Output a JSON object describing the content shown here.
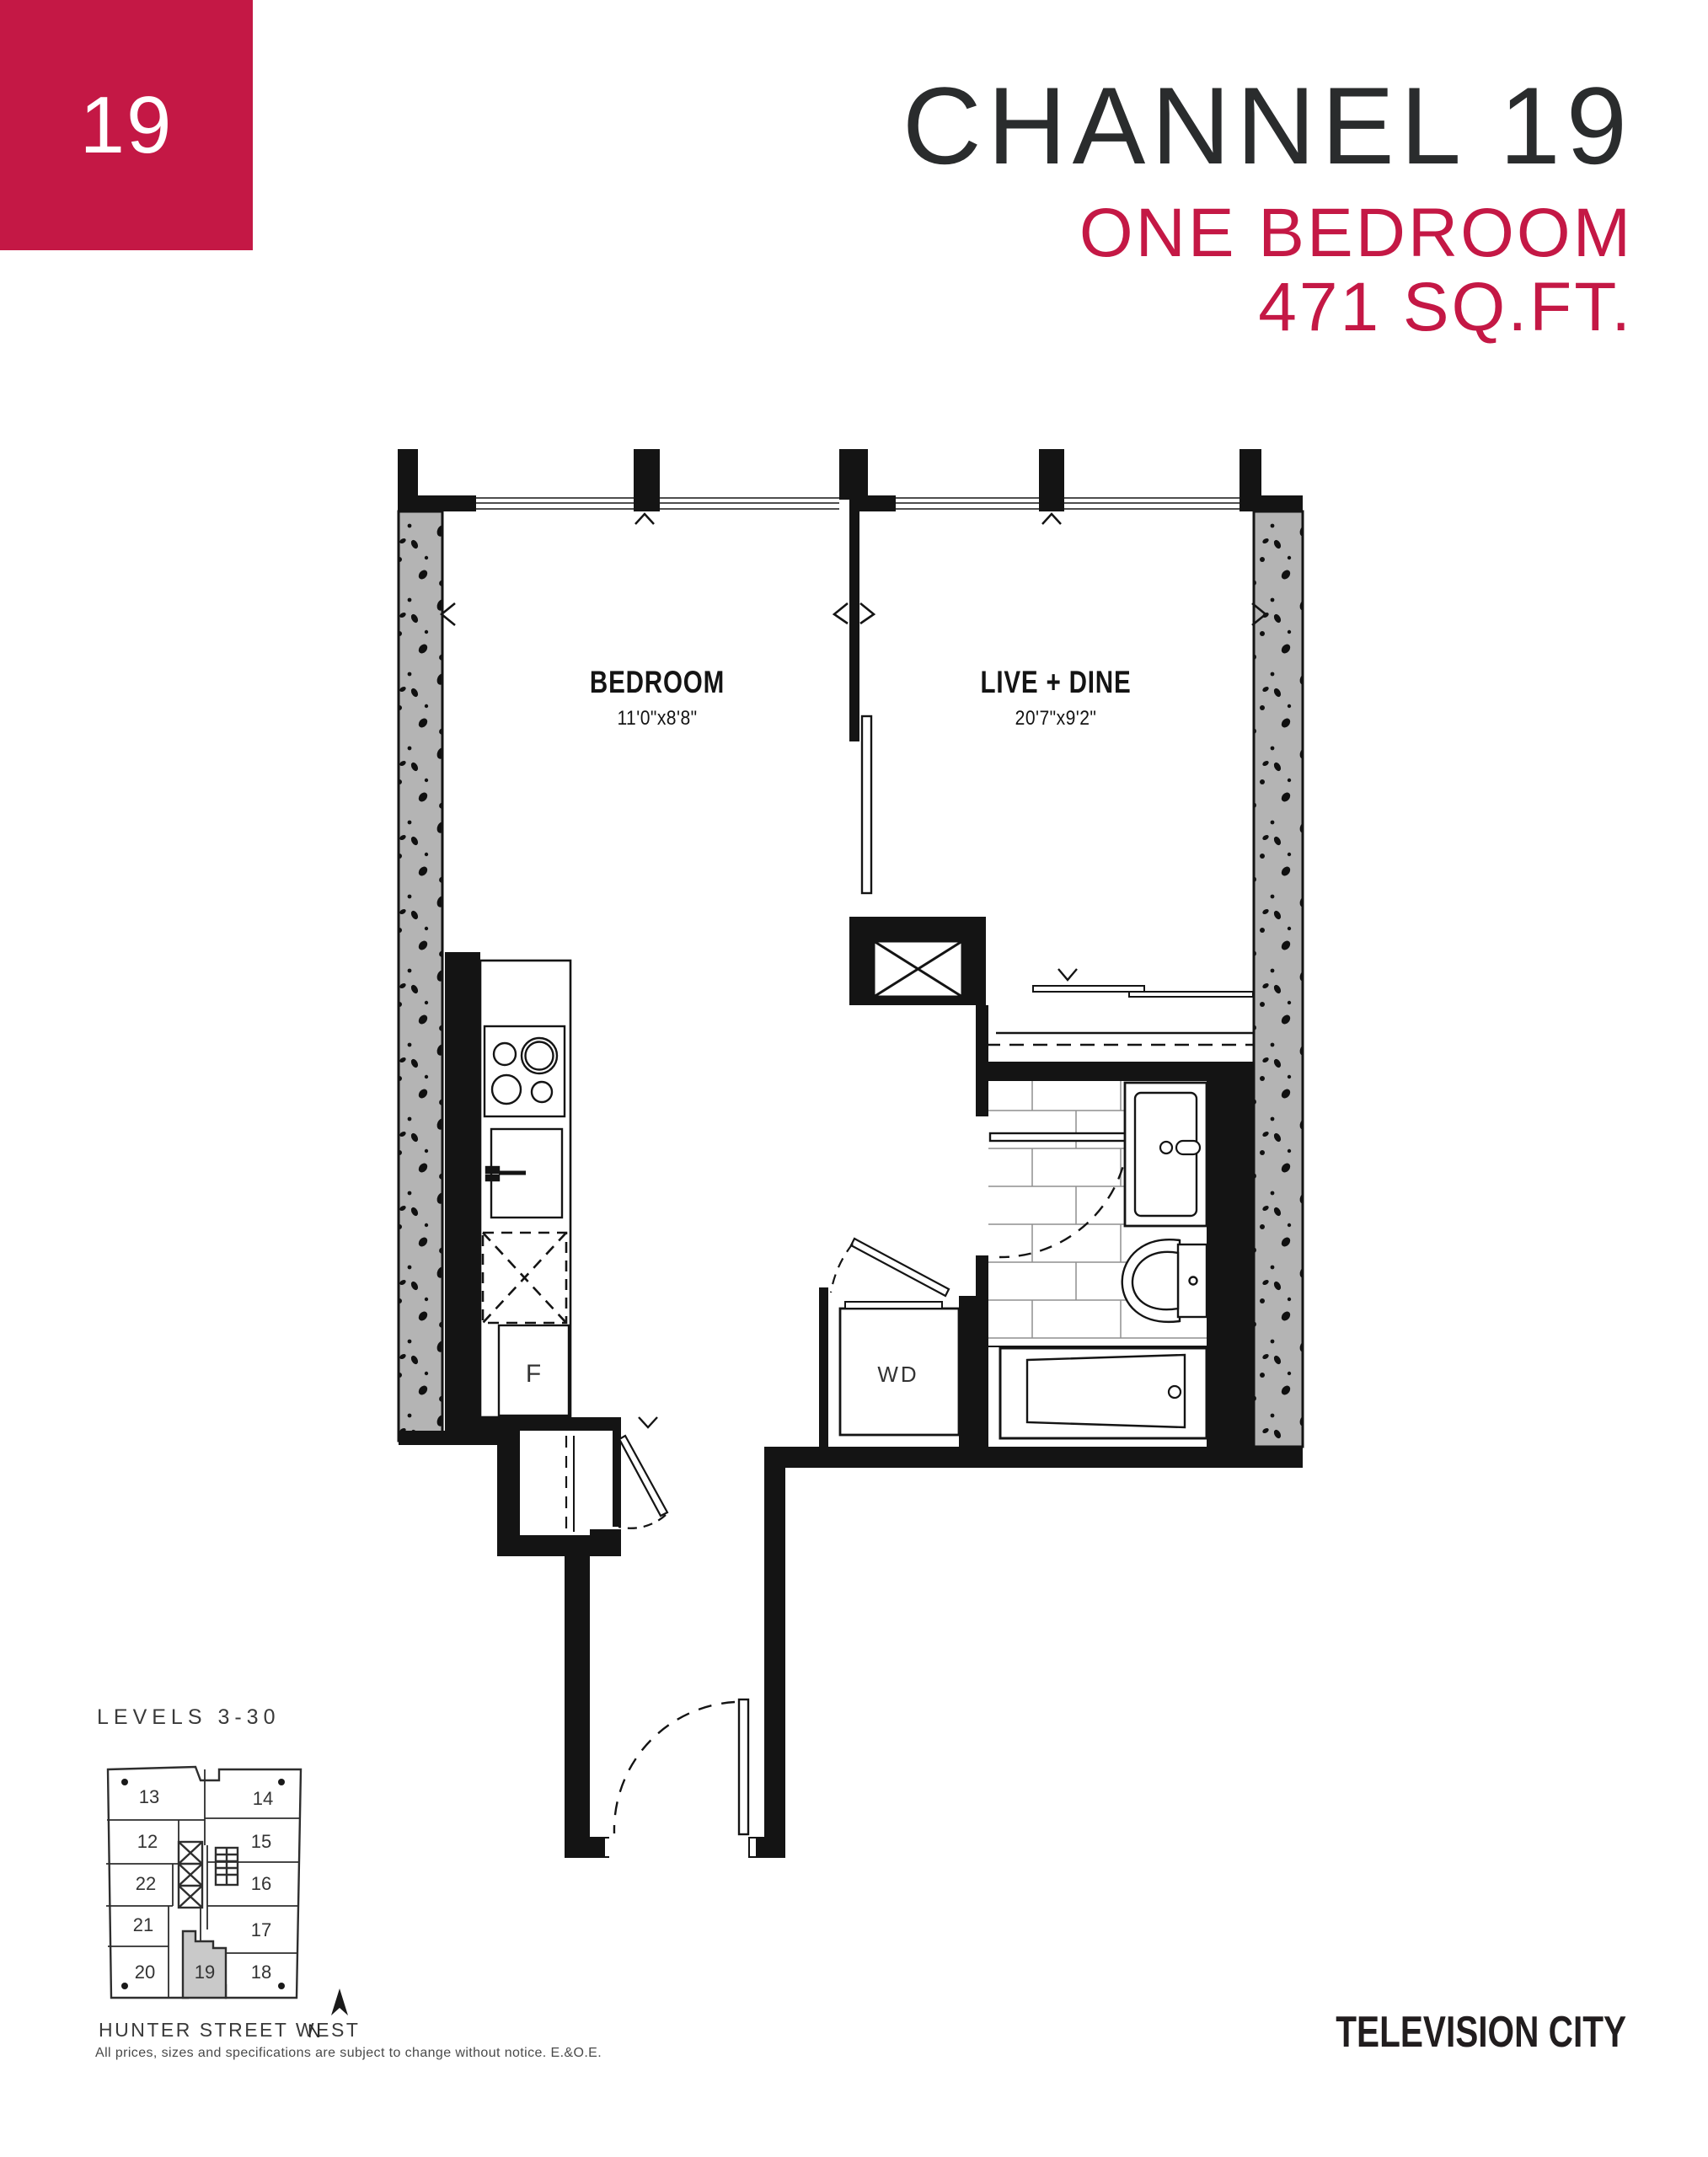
{
  "page": {
    "badge": "19",
    "title": "CHANNEL 19",
    "subtitle": "ONE BEDROOM",
    "area": "471 SQ.FT.",
    "logo": "TELEVISION CITY",
    "disclaimer": "All prices, sizes and specifications are subject to change without notice. E.&O.E."
  },
  "colors": {
    "accent": "#C41845",
    "ink": "#141414",
    "wall_gray": "#b4b4b4"
  },
  "floorplan": {
    "rooms": [
      {
        "name": "BEDROOM",
        "dims": "11'0\"x8'8\""
      },
      {
        "name": "LIVE + DINE",
        "dims": "20'7\"x9'2\""
      }
    ],
    "fixtures": {
      "fridge": "F",
      "washer_dryer": "WD"
    }
  },
  "keyplan": {
    "levels": "LEVELS 3-30",
    "street": "HUNTER STREET WEST",
    "north": "N",
    "units_left": [
      "13",
      "12",
      "22",
      "21",
      "20"
    ],
    "units_right": [
      "14",
      "15",
      "16",
      "17",
      "18"
    ],
    "unit_highlighted": "19"
  }
}
